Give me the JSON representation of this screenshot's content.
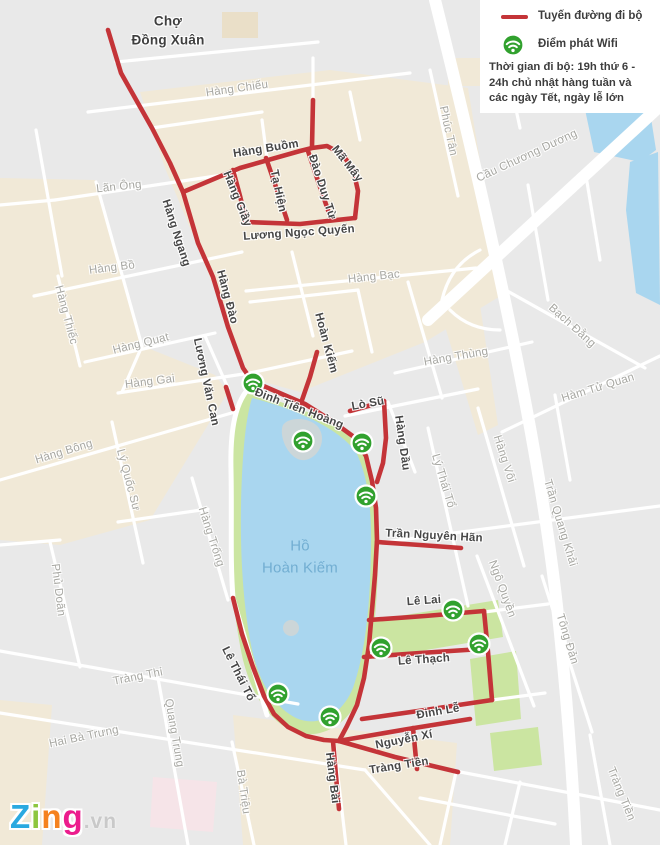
{
  "legend": {
    "route_label": "Tuyến đường đi bộ",
    "wifi_label": "Điểm phát Wifi",
    "note": "Thời gian đi bộ: 19h thứ 6 - 24h chủ nhật hàng tuần và các ngày Tết, ngày lễ lớn"
  },
  "colors": {
    "walking_route_red": "#c43438",
    "wifi_green": "#31a12e",
    "lake_blue": "#a9d6ef",
    "park_green": "#cbe5a1",
    "block_beige": "#f1e9d7",
    "background_gray": "#e9e9e9",
    "street_white": "#ffffff",
    "label_dark": "#474747",
    "label_gray": "#a7a7a2",
    "lake_label_blue": "#72aed2"
  },
  "map": {
    "lake_name": "Hồ Hoàn Kiếm",
    "labels": [
      {
        "text": "Chợ",
        "x": 168,
        "y": 21,
        "r": 0,
        "cls": "title"
      },
      {
        "text": "Đồng Xuân",
        "x": 168,
        "y": 40,
        "r": 0,
        "cls": "title"
      },
      {
        "text": "Hàng Chiếu",
        "x": 237,
        "y": 89,
        "r": -8,
        "cls": "gray"
      },
      {
        "text": "Hàng Buồm",
        "x": 266,
        "y": 149,
        "r": -9,
        "cls": "dark"
      },
      {
        "text": "Mã Mây",
        "x": 347,
        "y": 164,
        "r": 52,
        "cls": "dark"
      },
      {
        "text": "Đào Duy Từ",
        "x": 322,
        "y": 187,
        "r": 72,
        "cls": "dark"
      },
      {
        "text": "Tạ Hiện",
        "x": 278,
        "y": 191,
        "r": 78,
        "cls": "dark"
      },
      {
        "text": "Hàng Giầy",
        "x": 237,
        "y": 199,
        "r": 68,
        "cls": "dark"
      },
      {
        "text": "Hàng Ngang",
        "x": 176,
        "y": 233,
        "r": 72,
        "cls": "dark"
      },
      {
        "text": "Lương Ngọc Quyến",
        "x": 299,
        "y": 233,
        "r": -4,
        "cls": "dark"
      },
      {
        "text": "Lãn Ông",
        "x": 119,
        "y": 187,
        "r": -6,
        "cls": "gray"
      },
      {
        "text": "Hàng Bồ",
        "x": 112,
        "y": 268,
        "r": -7,
        "cls": "gray"
      },
      {
        "text": "Hàng Thiếc",
        "x": 66,
        "y": 315,
        "r": 75,
        "cls": "gray"
      },
      {
        "text": "Hàng Quạt",
        "x": 141,
        "y": 344,
        "r": -14,
        "cls": "gray"
      },
      {
        "text": "Hàng Đào",
        "x": 227,
        "y": 297,
        "r": 75,
        "cls": "dark"
      },
      {
        "text": "Hàng Bạc",
        "x": 374,
        "y": 277,
        "r": -6,
        "cls": "gray"
      },
      {
        "text": "Hàng Bông",
        "x": 64,
        "y": 452,
        "r": -17,
        "cls": "gray"
      },
      {
        "text": "Lương Văn Can",
        "x": 206,
        "y": 382,
        "r": 78,
        "cls": "dark"
      },
      {
        "text": "Hàng Gai",
        "x": 150,
        "y": 382,
        "r": -7,
        "cls": "gray"
      },
      {
        "text": "Hoàn Kiếm",
        "x": 326,
        "y": 343,
        "r": 75,
        "cls": "dark"
      },
      {
        "text": "Hàng Thùng",
        "x": 456,
        "y": 357,
        "r": -10,
        "cls": "gray"
      },
      {
        "text": "Đinh Tiên Hoàng",
        "x": 299,
        "y": 409,
        "r": 21,
        "cls": "dark"
      },
      {
        "text": "Lò Sũ",
        "x": 368,
        "y": 404,
        "r": -10,
        "cls": "dark"
      },
      {
        "text": "Hàng Dầu",
        "x": 402,
        "y": 443,
        "r": 82,
        "cls": "dark"
      },
      {
        "text": "Phúc Tân",
        "x": 448,
        "y": 131,
        "r": 78,
        "cls": "gray"
      },
      {
        "text": "Cầu Chương Dương",
        "x": 527,
        "y": 156,
        "r": -25,
        "cls": "gray"
      },
      {
        "text": "Bạch Đằng",
        "x": 572,
        "y": 326,
        "r": 42,
        "cls": "gray"
      },
      {
        "text": "Hàm Tử Quan",
        "x": 598,
        "y": 388,
        "r": -17,
        "cls": "gray"
      },
      {
        "text": "Trần Quang Khải",
        "x": 560,
        "y": 523,
        "r": 73,
        "cls": "gray"
      },
      {
        "text": "Hàng Vôi",
        "x": 504,
        "y": 459,
        "r": 72,
        "cls": "gray"
      },
      {
        "text": "Lý Thái Tổ",
        "x": 443,
        "y": 481,
        "r": 73,
        "cls": "gray"
      },
      {
        "text": "Lý Quốc Sư",
        "x": 128,
        "y": 480,
        "r": 75,
        "cls": "gray"
      },
      {
        "text": "Hàng Trống",
        "x": 211,
        "y": 537,
        "r": 72,
        "cls": "gray"
      },
      {
        "text": "Phủ Doãn",
        "x": 58,
        "y": 590,
        "r": 83,
        "cls": "gray"
      },
      {
        "text": "Trần Nguyên Hãn",
        "x": 434,
        "y": 536,
        "r": 3,
        "cls": "dark"
      },
      {
        "text": "Lê Lai",
        "x": 424,
        "y": 601,
        "r": -4,
        "cls": "dark"
      },
      {
        "text": "Lê Thạch",
        "x": 424,
        "y": 660,
        "r": -4,
        "cls": "dark"
      },
      {
        "text": "Đinh Lễ",
        "x": 438,
        "y": 712,
        "r": -10,
        "cls": "dark"
      },
      {
        "text": "Nguyễn Xí",
        "x": 404,
        "y": 740,
        "r": -11,
        "cls": "dark"
      },
      {
        "text": "Tràng Tiền",
        "x": 399,
        "y": 766,
        "r": -9,
        "cls": "dark"
      },
      {
        "text": "Hàng Bài",
        "x": 332,
        "y": 778,
        "r": 83,
        "cls": "dark"
      },
      {
        "text": "Lê Thái Tổ",
        "x": 238,
        "y": 674,
        "r": 63,
        "cls": "dark"
      },
      {
        "text": "Ngô Quyền",
        "x": 502,
        "y": 589,
        "r": 70,
        "cls": "gray"
      },
      {
        "text": "Tông Đản",
        "x": 567,
        "y": 639,
        "r": 73,
        "cls": "gray"
      },
      {
        "text": "Bà Triệu",
        "x": 243,
        "y": 792,
        "r": 82,
        "cls": "gray"
      },
      {
        "text": "Quang Trung",
        "x": 174,
        "y": 733,
        "r": 80,
        "cls": "gray"
      },
      {
        "text": "Tràng Thi",
        "x": 138,
        "y": 677,
        "r": -11,
        "cls": "gray"
      },
      {
        "text": "Hai Bà Trưng",
        "x": 84,
        "y": 737,
        "r": -12,
        "cls": "gray"
      },
      {
        "text": "Tràng Tiền",
        "x": 621,
        "y": 794,
        "r": 68,
        "cls": "gray"
      },
      {
        "text": "Hồ",
        "x": 300,
        "y": 546,
        "r": 0,
        "cls": "blue"
      },
      {
        "text": "Hoàn Kiếm",
        "x": 300,
        "y": 568,
        "r": 0,
        "cls": "blue"
      }
    ],
    "routes": [
      "108,30 121,73 152,128 170,163 183,192 198,243 213,277 228,327 243,368 252,381",
      "183,192 240,168 300,151 312,148 327,146 342,154 353,169 358,191 355,218",
      "313,100 312,147",
      "308,151 318,181 330,216",
      "266,158 277,190 287,220",
      "233,170 240,196 246,220",
      "245,222 300,224 355,218",
      "226,387 233,409",
      "252,381 275,391 305,404 332,421 354,437 366,456 372,481 376,508 377,540 375,575 372,610 369,645 364,678 357,705 347,726 339,741",
      "233,598 242,634 253,667 264,696 274,714 288,727 306,736 324,740 339,741",
      "333,741 336,776 339,809",
      "339,741 395,757 458,772",
      "301,403 310,377 317,352",
      "350,411 368,406 384,401",
      "384,401 386,438 383,463 377,482",
      "377,542 420,545 461,548",
      "369,620 425,616 484,611",
      "364,657 420,653 481,649",
      "484,611 488,652 492,700",
      "362,719 425,710 492,700",
      "344,740 408,729 470,719",
      "413,728 417,769"
    ],
    "wifi_points": [
      {
        "x": 253,
        "y": 383
      },
      {
        "x": 303,
        "y": 441
      },
      {
        "x": 362,
        "y": 443
      },
      {
        "x": 366,
        "y": 496
      },
      {
        "x": 453,
        "y": 610
      },
      {
        "x": 479,
        "y": 644
      },
      {
        "x": 381,
        "y": 648
      },
      {
        "x": 278,
        "y": 694
      },
      {
        "x": 330,
        "y": 717
      }
    ]
  },
  "logo": {
    "letters": [
      {
        "ch": "Z",
        "color": "#2aa9e0"
      },
      {
        "ch": "i",
        "color": "#8dc63f"
      },
      {
        "ch": "n",
        "color": "#f5821f"
      },
      {
        "ch": "g",
        "color": "#ec1c8d"
      }
    ],
    "suffix": ".vn"
  }
}
